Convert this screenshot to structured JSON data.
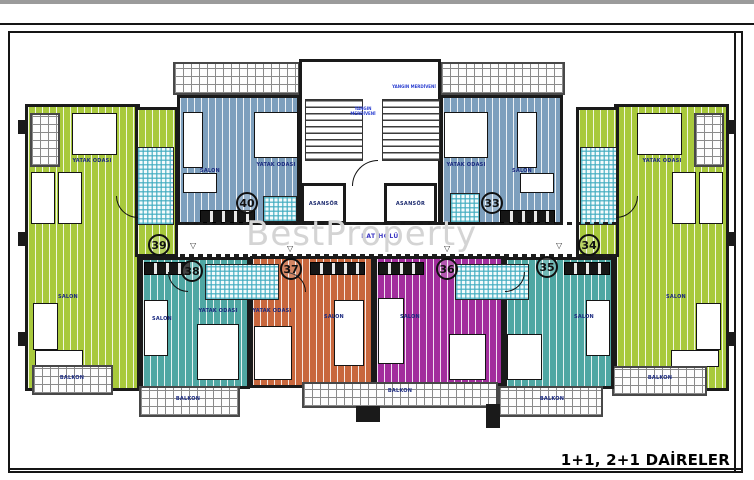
{
  "sheet": {
    "title": "1+1, 2+1 DAİRELER",
    "watermark": "BestProperty"
  },
  "hall": {
    "label": "KAT HOLÜ"
  },
  "core": {
    "elevator_label": "ASANSÖR",
    "stair_label": "YANGIN MERDİVENİ"
  },
  "rooms": {
    "salon": "SALON",
    "bedroom": "YATAK ODASI",
    "balcony": "BALKON"
  },
  "markers": {
    "down": "▽",
    "up": "△"
  },
  "units": [
    {
      "no": "40",
      "color_name": "blue",
      "hex": "#7d9fbd",
      "position": "top-left"
    },
    {
      "no": "33",
      "color_name": "blue",
      "hex": "#7d9fbd",
      "position": "top-right"
    },
    {
      "no": "39",
      "color_name": "green",
      "hex": "#a8c93c",
      "position": "left"
    },
    {
      "no": "34",
      "color_name": "green",
      "hex": "#a8c93c",
      "position": "right"
    },
    {
      "no": "38",
      "color_name": "teal",
      "hex": "#4fa7a3",
      "position": "bottom-left"
    },
    {
      "no": "37",
      "color_name": "orange",
      "hex": "#c8673d",
      "position": "bottom-center-left"
    },
    {
      "no": "36",
      "color_name": "purple",
      "hex": "#a22d9d",
      "position": "bottom-center-right"
    },
    {
      "no": "35",
      "color_name": "teal",
      "hex": "#4fa7a3",
      "position": "bottom-right"
    }
  ],
  "colors": {
    "wall": "#1a1a1a",
    "bath_tile": "#3caabe",
    "grid_line": "#8a8a8a"
  }
}
